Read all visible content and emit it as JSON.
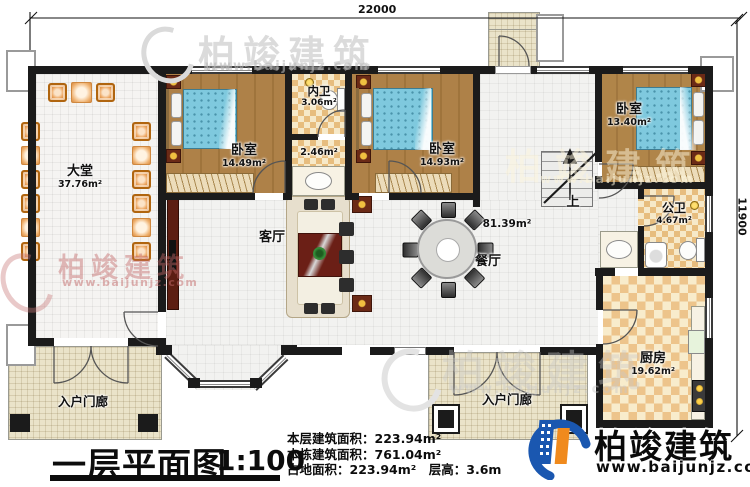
{
  "dimensions": {
    "width_label": "22000",
    "height_label": "11900"
  },
  "rooms": {
    "datang": {
      "name": "大堂",
      "area": "37.76m²"
    },
    "bedroom1": {
      "name": "卧室",
      "area": "14.49m²"
    },
    "neiwei": {
      "name": "内卫",
      "area": "3.06m²"
    },
    "corridor": {
      "area": "2.46m²"
    },
    "bedroom2": {
      "name": "卧室",
      "area": "14.93m²"
    },
    "bedroom3": {
      "name": "卧室",
      "area": "13.40m²"
    },
    "living": {
      "name": "客厅"
    },
    "dining": {
      "name": "餐厅"
    },
    "open_area": {
      "area": "81.39m²"
    },
    "gongwei": {
      "name": "公卫",
      "area": "4.67m²"
    },
    "kitchen": {
      "name": "厨房",
      "area": "19.62m²"
    },
    "porch_left": {
      "name": "入户门廊"
    },
    "porch_right": {
      "name": "入户门廊"
    },
    "stairs": {
      "label": "上"
    }
  },
  "title_block": {
    "title": "一层平面图",
    "scale": "1:100",
    "stats": [
      "本层建筑面积：223.94m²",
      "本栋建筑面积：761.04m²",
      "占地面积：223.94m²",
      "层高：3.6m"
    ]
  },
  "branding": {
    "logo_text": "柏竣建筑",
    "logo_url": "www.baijunjz.com"
  },
  "watermark": {
    "text": "柏竣建筑",
    "url": "www.baijunjz.com"
  },
  "colors": {
    "wall": "#1b1b1b",
    "wood_floor": "#aa7d45",
    "bed_blue": "#7fc9de",
    "checker_tan": "#e7bd7e",
    "porch_beige": "#eae3c9",
    "accent_maroon": "#5c1e12",
    "logo_blue": "#1a57b0",
    "logo_orange": "#f08a1d"
  }
}
